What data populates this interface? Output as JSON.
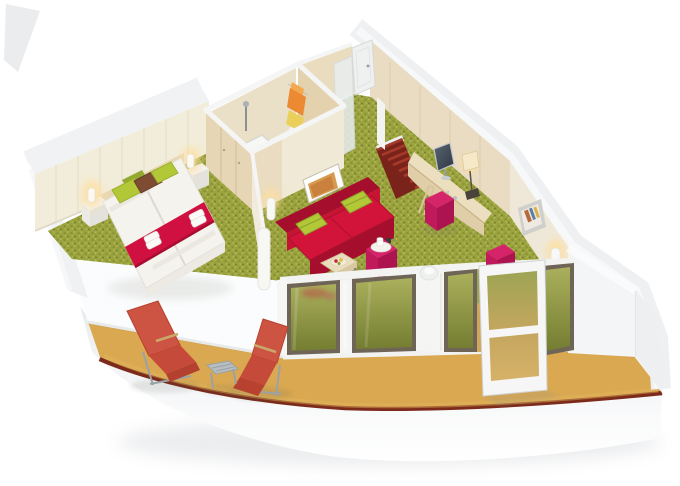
{
  "image": {
    "alt": "3D cutaway floor plan rendering of a cruise ship balcony cabin: bedroom with twin beds, bathroom with shower, living area with red sofa and desk, entry corridor with red striped carpet, and a curved private balcony with two red deck loungers and a side table",
    "type": "3d-cutaway-floorplan",
    "subject": "cruise ship balcony suite"
  },
  "palette": {
    "background": "#ffffff",
    "hull_light": "#edeff1",
    "rail_red": "#7c2b1a",
    "rail_highlight": "#9c4530",
    "balcony_floor": "#d9a851",
    "balcony_floor_shadow": "#c4923f",
    "balcony_floor_light": "#e3b55e",
    "carpet_base": "#9ba33f",
    "carpet_dot_dark": "#848d33",
    "carpet_dot_light": "#bcc25e",
    "carpet_dot_deep": "#6f7a2c",
    "cream_wall": "#f2edda",
    "wood_wall": "#e9dcc2",
    "wood_dark": "#e0cfa9",
    "wardrobe_wood": "#e6d6b5",
    "cap_white": "#f1f2f3",
    "partition_white": "#fbfcfd",
    "sofa_red": "#c81434",
    "sofa_dark": "#a50e2c",
    "seat_red": "#d3143a",
    "pillow_green": "#b2c837",
    "pillow_green_dark": "#93a930",
    "pillow_brown": "#7d4c33",
    "bed_white": "#f5f3ee",
    "runner_red": "#d01040",
    "magenta": "#d6246b",
    "magenta_dark": "#ad1350",
    "magenta_mid": "#c11a5c",
    "entry_carpet": "#7a231a",
    "entry_stripe": "#a53a2b",
    "glass_top": "#a8ad58",
    "glass_bottom": "#767f33",
    "frame_dark": "#6f6557",
    "frame_white": "#f5f6f5",
    "deck_chair_red": "#cd5342",
    "deck_chair_seat": "#c64a39",
    "metal_gray": "#9aa1a7",
    "table_gray": "#b7bec2",
    "towel_orange": "#ec8a33",
    "towel_yellow": "#ead05b",
    "lamp_glow": "#ffdf9e",
    "desk_wood": "#ecdfc0",
    "table_wood": "#eaddbe",
    "shower_floor": "#efede6"
  },
  "scene": {
    "rooms": [
      "bedroom",
      "bathroom",
      "living-area",
      "entry-corridor",
      "balcony"
    ],
    "objects": [
      "twin-beds",
      "bed-runner-with-towels",
      "green-and-brown-pillows",
      "bedside-tables",
      "wall-lamps",
      "wardrobe",
      "shower",
      "towel-rack",
      "red-sofa",
      "wall-art",
      "coffee-table-with-tray",
      "magenta-ottomans",
      "curved-desk-with-tv-and-lamp",
      "desk-stool",
      "framed-picture",
      "wall-sconce",
      "glass-balcony-doors",
      "open-balcony-door",
      "two-red-deck-loungers",
      "balcony-side-table"
    ]
  }
}
